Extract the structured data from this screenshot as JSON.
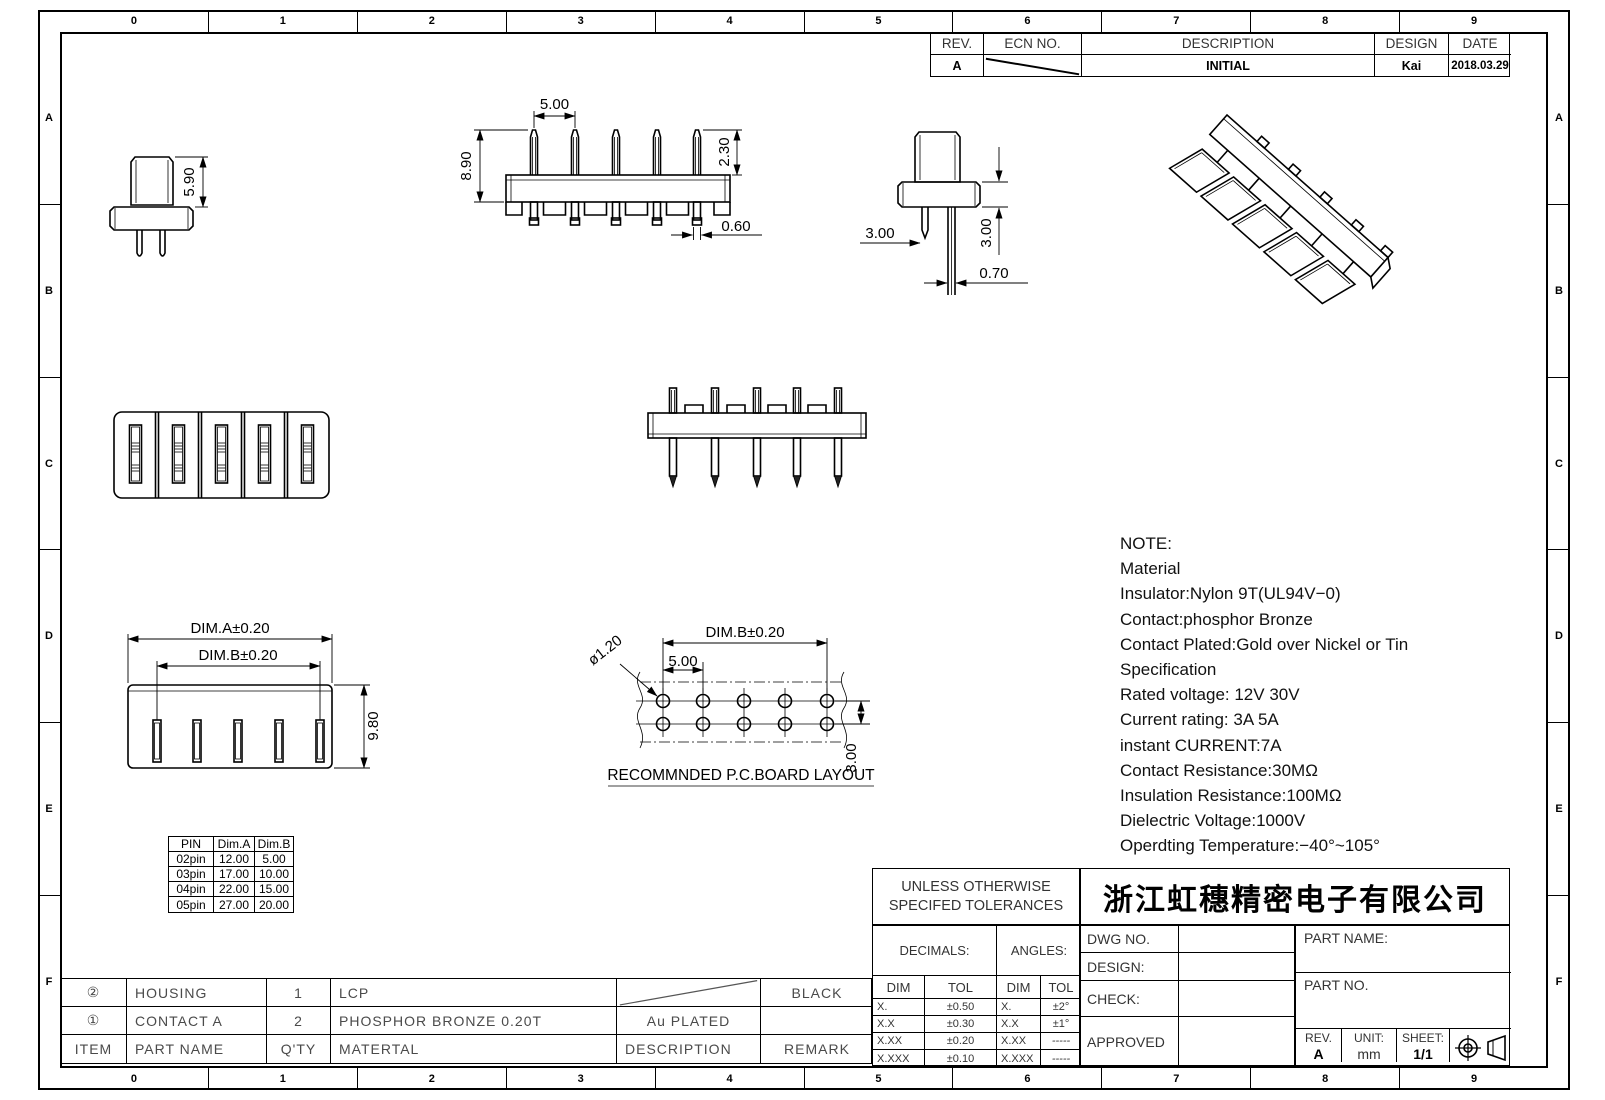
{
  "sheet": {
    "zone_columns": [
      "0",
      "1",
      "2",
      "3",
      "4",
      "5",
      "6",
      "7",
      "8",
      "9"
    ],
    "zone_rows": [
      "A",
      "B",
      "C",
      "D",
      "E",
      "F"
    ]
  },
  "revision_table": {
    "headers": {
      "rev": "REV.",
      "ecn": "ECN NO.",
      "description": "DESCRIPTION",
      "design": "DESIGN",
      "date": "DATE"
    },
    "row": {
      "rev": "A",
      "description": "INITIAL",
      "design": "Kai",
      "date": "2018.03.29"
    }
  },
  "views": {
    "side_view_a": {
      "height": "5.90"
    },
    "front_view_a": {
      "pitch": "5.00",
      "height": "8.90",
      "pin_top": "2.30",
      "pin_width": "0.60"
    },
    "side_view_b": {
      "pin_length": "3.00",
      "tail_length": "3.00",
      "pin_width": "0.70"
    },
    "bottom_view": {
      "dim_a": "DIM.A±0.20",
      "dim_b": "DIM.B±0.20",
      "height": "9.80"
    },
    "pcb_layout": {
      "dim_b": "DIM.B±0.20",
      "hole_dia": "ø1.20",
      "pitch": "5.00",
      "row_pitch": "3.00",
      "caption": "RECOMMNDED P.C.BOARD LAYOUT"
    }
  },
  "note": {
    "lines": [
      "NOTE:",
      "Material",
      "Insulator:Nylon 9T(UL94V−0)",
      "Contact:phosphor Bronze",
      "Contact Plated:Gold over Nickel or Tin",
      "Specification",
      "Rated voltage: 12V 30V",
      "Current rating: 3A   5A",
      "instant CURRENT:7A",
      "Contact Resistance:30MΩ",
      "Insulation Resistance:100MΩ",
      "Dielectric Voltage:1000V",
      "Operdting Temperature:−40°~105°"
    ]
  },
  "pin_table": {
    "headers": [
      "PIN",
      "Dim.A",
      "Dim.B"
    ],
    "rows": [
      [
        "02pin",
        "12.00",
        "5.00"
      ],
      [
        "03pin",
        "17.00",
        "10.00"
      ],
      [
        "04pin",
        "22.00",
        "15.00"
      ],
      [
        "05pin",
        "27.00",
        "20.00"
      ]
    ]
  },
  "bom_table": {
    "headers": {
      "item": "ITEM",
      "part_name": "PART NAME",
      "qty": "Q'TY",
      "material": "MATERTAL",
      "description": "DESCRIPTION",
      "remark": "REMARK"
    },
    "rows": [
      {
        "item": "②",
        "part_name": "HOUSING",
        "qty": "1",
        "material": "LCP",
        "description": "",
        "remark": "BLACK"
      },
      {
        "item": "①",
        "part_name": "CONTACT A",
        "qty": "2",
        "material": "PHOSPHOR BRONZE 0.20T",
        "description": "Au PLATED",
        "remark": ""
      }
    ]
  },
  "title_block": {
    "tolerance_title_line1": "UNLESS OTHERWISE",
    "tolerance_title_line2": "SPECIFED TOLERANCES",
    "decimals_label": "DECIMALS:",
    "angles_label": "ANGLES:",
    "dim_header": "DIM",
    "tol_header": "TOL",
    "decimals_rows": [
      [
        "X.",
        "±0.50"
      ],
      [
        "X.X",
        "±0.30"
      ],
      [
        "X.XX",
        "±0.20"
      ],
      [
        "X.XXX",
        "±0.10"
      ]
    ],
    "angles_rows": [
      [
        "X.",
        "±2°"
      ],
      [
        "X.X",
        "±1°"
      ],
      [
        "X.XX",
        "-----"
      ],
      [
        "X.XXX",
        "-----"
      ]
    ],
    "company": "浙江虹穗精密电子有限公司",
    "dwg_no_label": "DWG NO.",
    "design_label": "DESIGN:",
    "check_label": "CHECK:",
    "approved_label": "APPROVED",
    "part_name_label": "PART NAME:",
    "part_no_label": "PART NO.",
    "rev_label": "REV.",
    "rev_value": "A",
    "unit_label": "UNIT:",
    "unit_value": "mm",
    "sheet_label": "SHEET:",
    "sheet_value": "1/1"
  }
}
